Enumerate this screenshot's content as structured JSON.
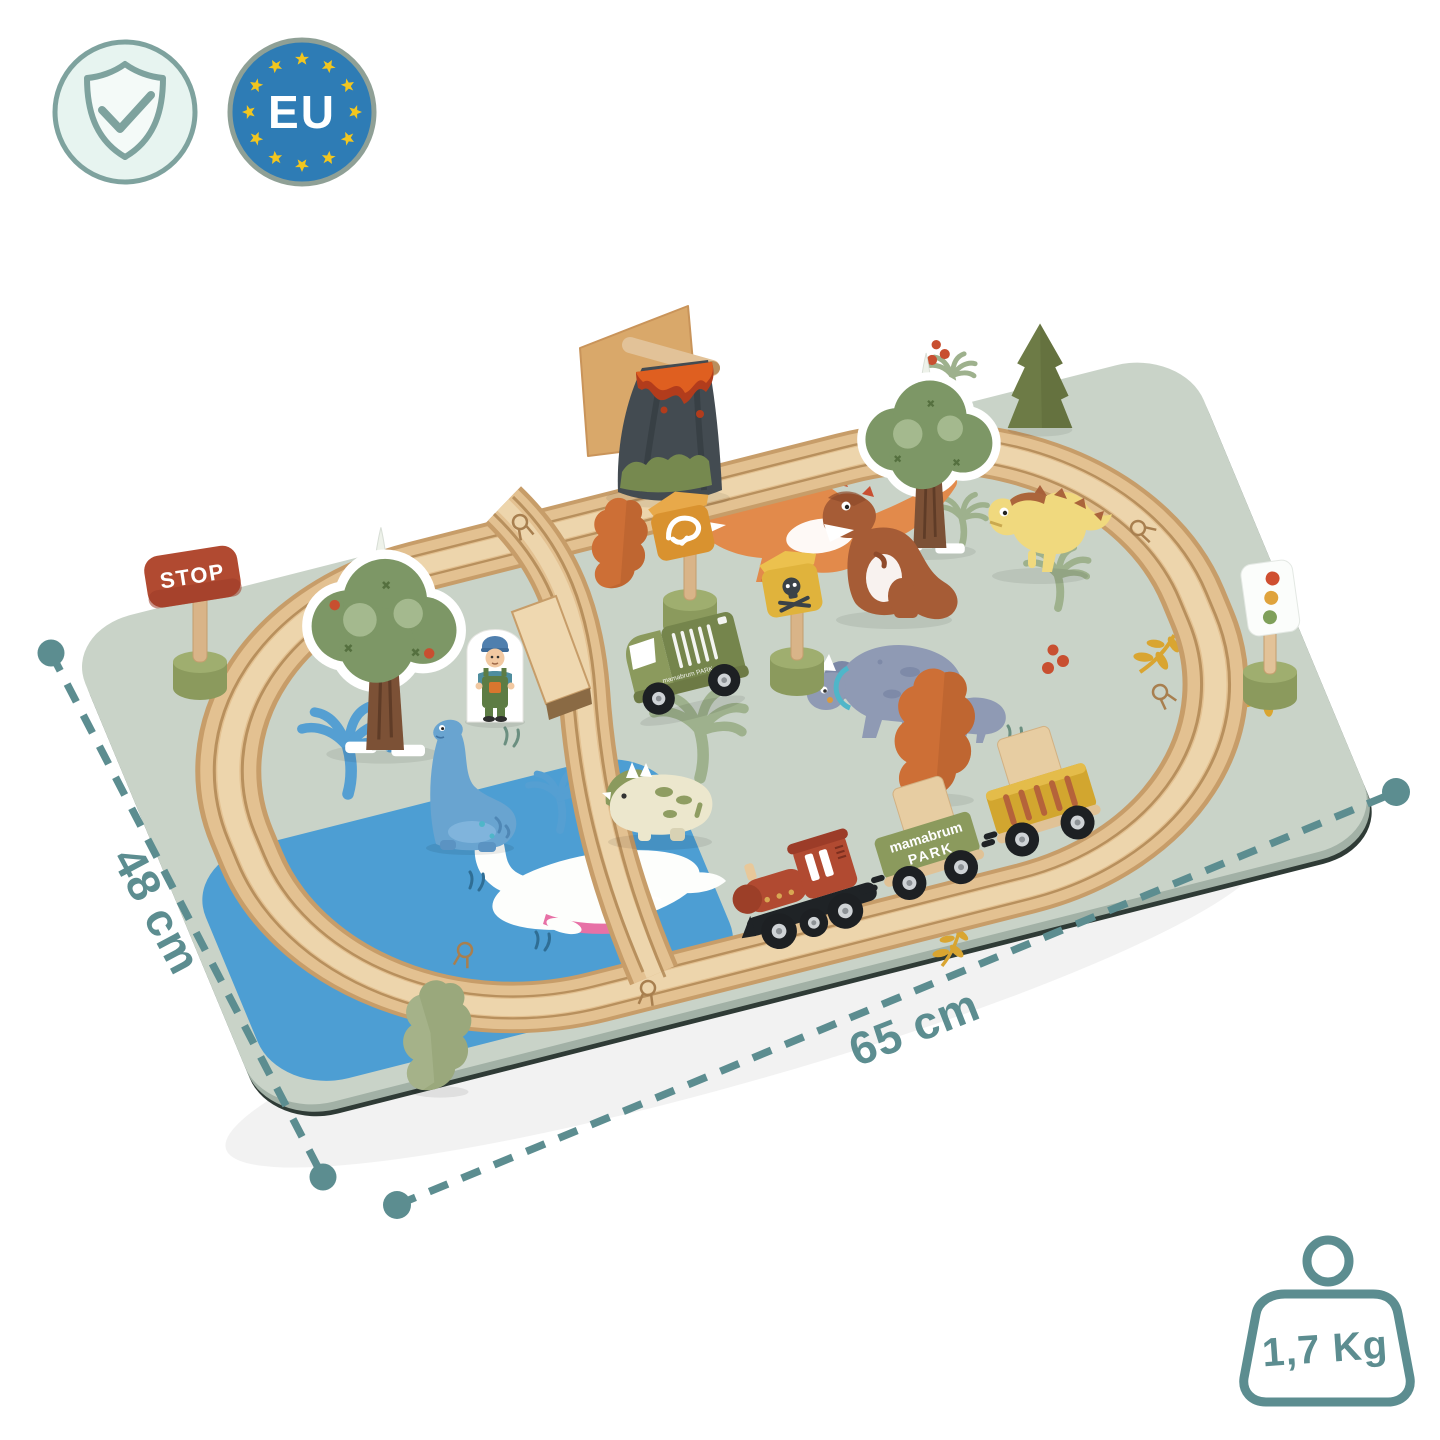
{
  "badges": {
    "quality": {
      "icon": "shield-check"
    },
    "eu": {
      "label": "EU"
    }
  },
  "annotations": {
    "depth": "48 cm",
    "width": "65 cm",
    "weight": "1,7 Kg"
  },
  "toy": {
    "stop_sign": "STOP",
    "wagon_brand_line1": "mamabrum",
    "wagon_brand_line2": "PARK",
    "van_text": "mamabrum PARK"
  },
  "colors": {
    "accent": "#5c8d90",
    "eublue": "#2e7cb5",
    "star": "#f2c61f",
    "ring": "#8fa096",
    "shieldfill": "#e7f4f0",
    "shieldstroke": "#7ea29e",
    "mat": "#c9d3c8",
    "matside": "#a2b1a6",
    "lake": "#4d9ed3",
    "wood": "#e3c191",
    "woodlight": "#efd8b0",
    "wooddark": "#c79d69",
    "groove": "#ac8350",
    "olive": "#8b9a5d",
    "olivedark": "#75854c",
    "olivelight": "#9fae6f",
    "pinegreen": "#6d7b46",
    "sageblock": "#9aa87c",
    "orangeblock": "#cd6f36",
    "rust": "#b14a31",
    "charcoal": "#434b51",
    "lava": "#df5f20",
    "lavadark": "#b23c1c",
    "signorange": "#d9922f",
    "signyellow": "#e0b33c",
    "treegreen": "#7d9766",
    "treegreenlight": "#a9bd92",
    "trunk": "#7c5136",
    "printblue": "#559fd2",
    "printsage": "#9eb18d",
    "mustard": "#d9a531",
    "berry": "#c84f30",
    "dinogray": "#8f9ab4",
    "dinograydark": "#7c88a6",
    "dinoteal": "#4fb6c9",
    "cream": "#ece7cd",
    "dinoyellow": "#f0d97e",
    "dinobrown": "#a65c36",
    "dinoorange": "#e28a4b",
    "dinoblue": "#69a4d0",
    "black": "#1f2326",
    "hub": "#cfd3d6",
    "grassmat": "#6b8f80",
    "grasslake": "#2f6e95"
  }
}
